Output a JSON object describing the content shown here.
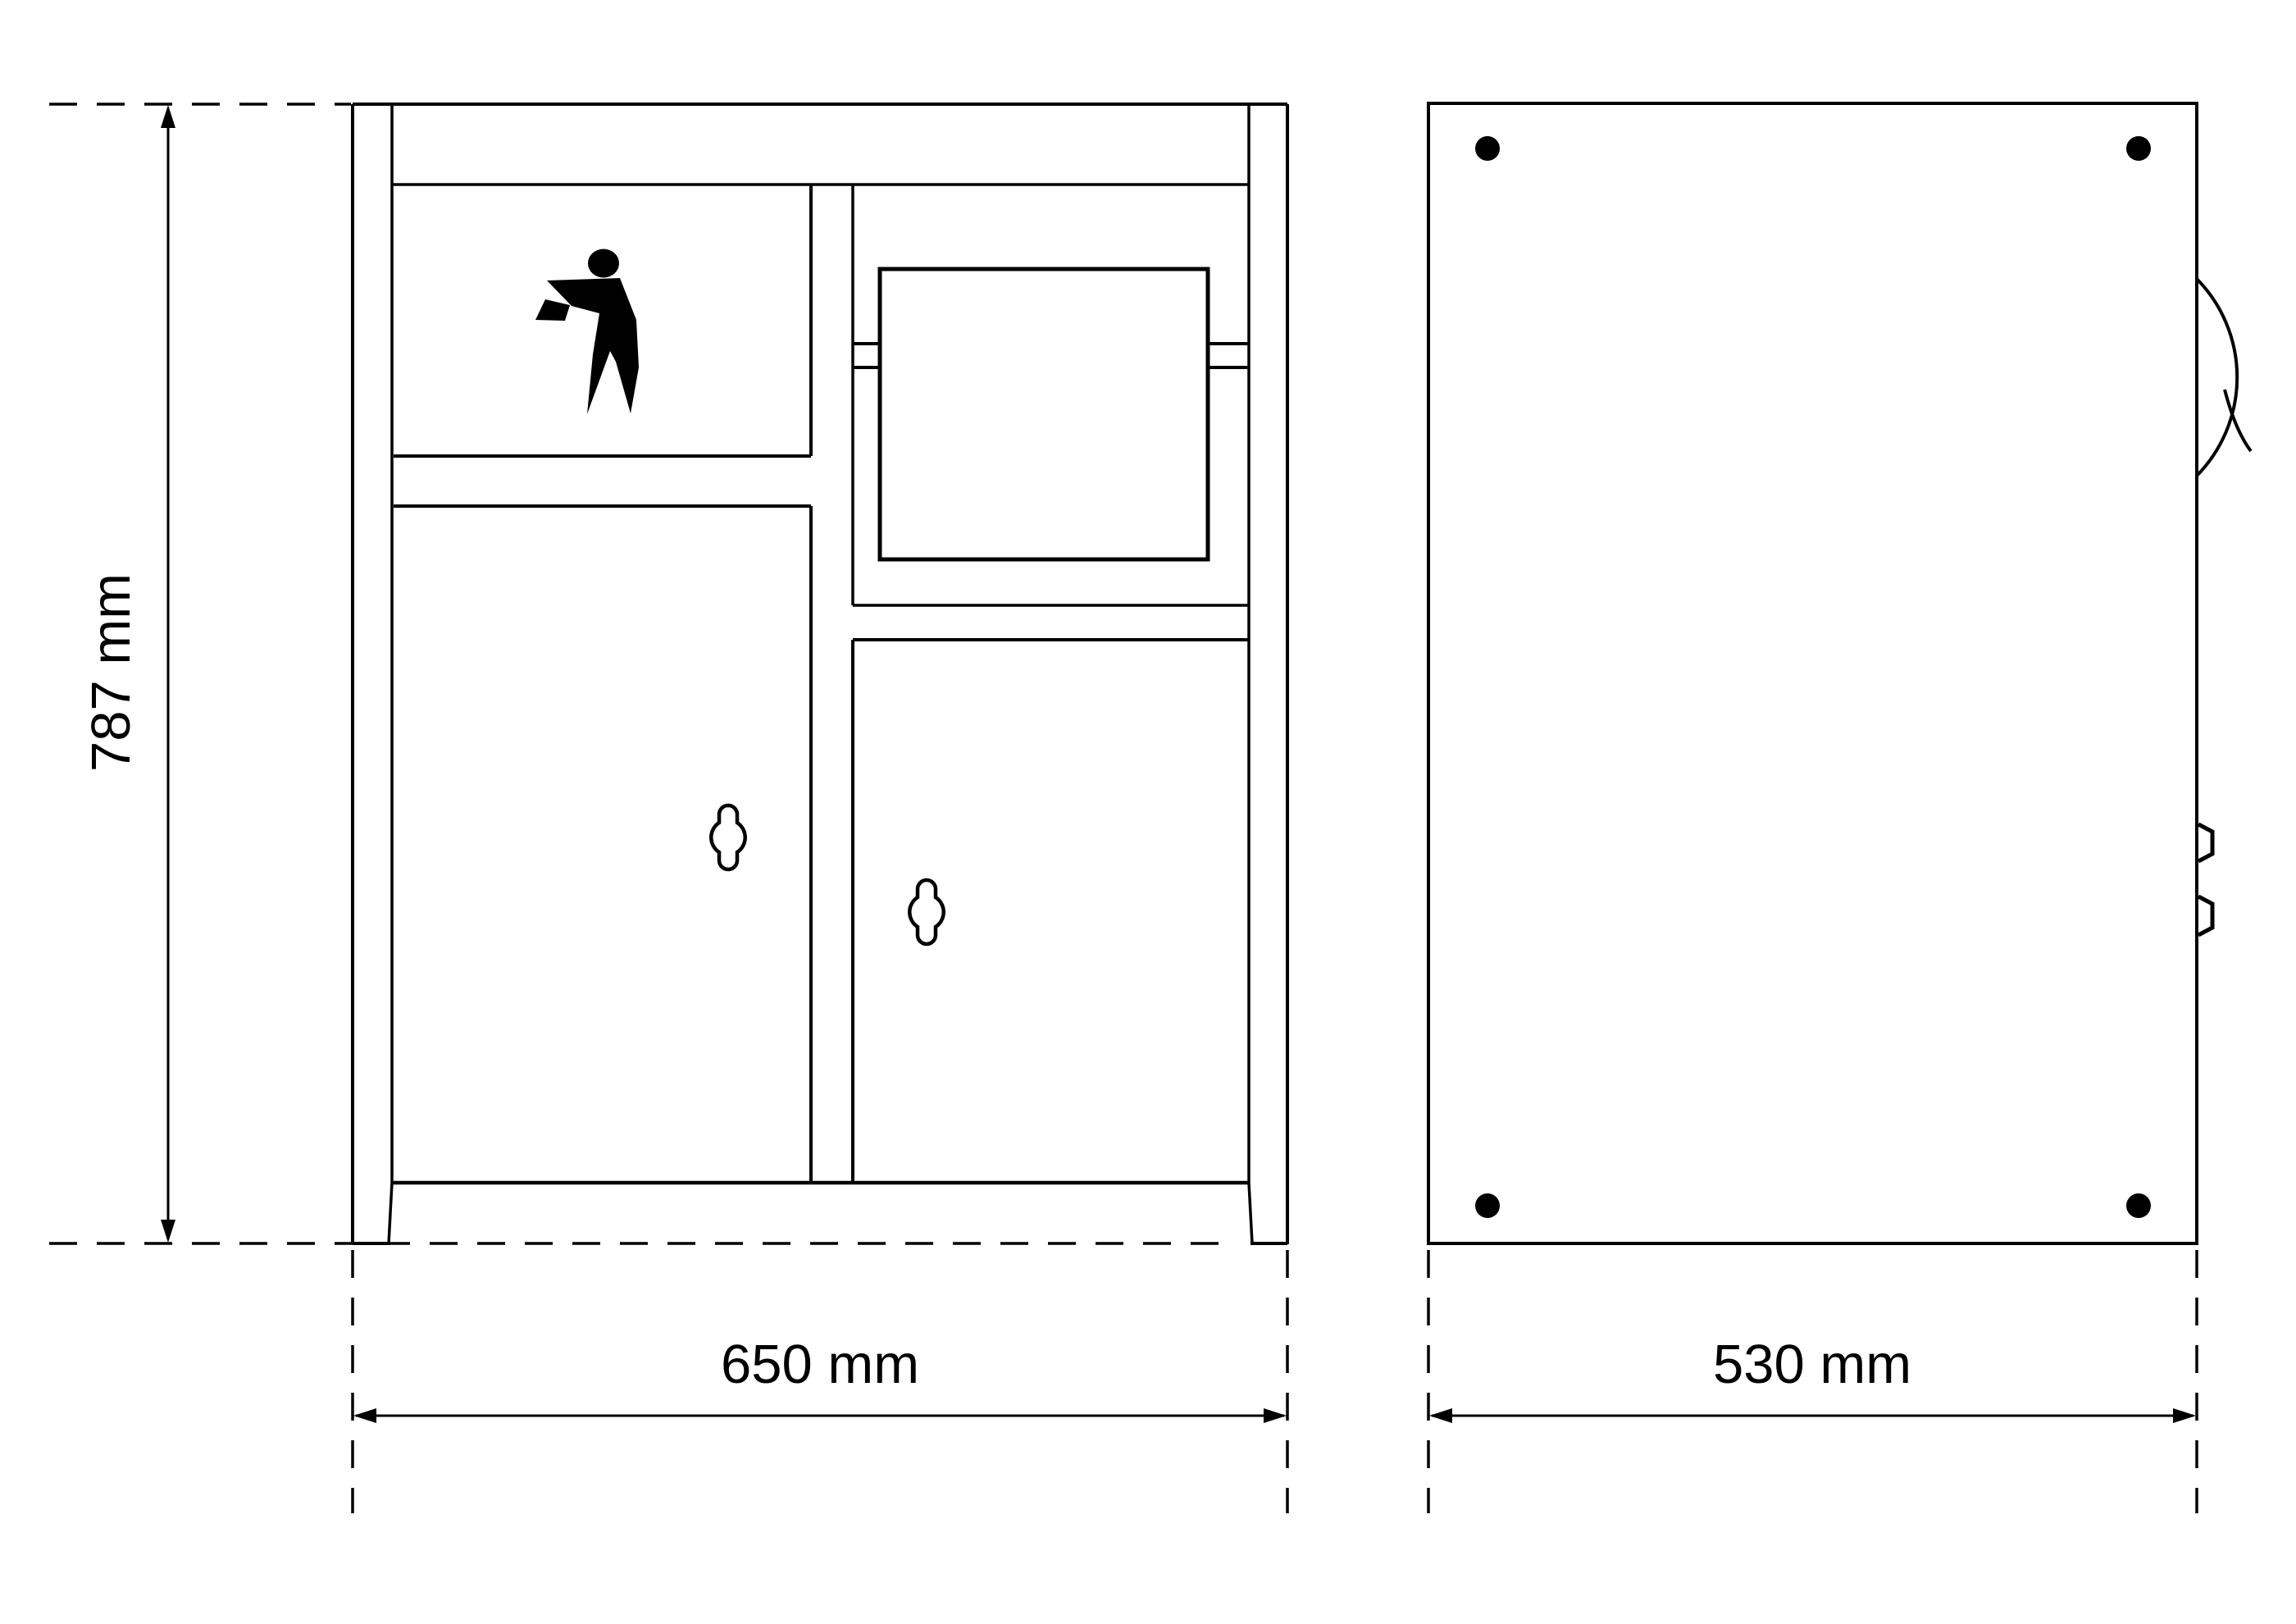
{
  "drawing": {
    "background": "#ffffff",
    "line_color": "#000000",
    "front_view": {
      "height_label": "787 mm",
      "width_label": "650 mm"
    },
    "side_view": {
      "depth_label": "530 mm"
    },
    "icons": {
      "tidyman": "tidyman-litter-disposal",
      "keyhole_count": 2,
      "bolt_count": 4
    }
  }
}
